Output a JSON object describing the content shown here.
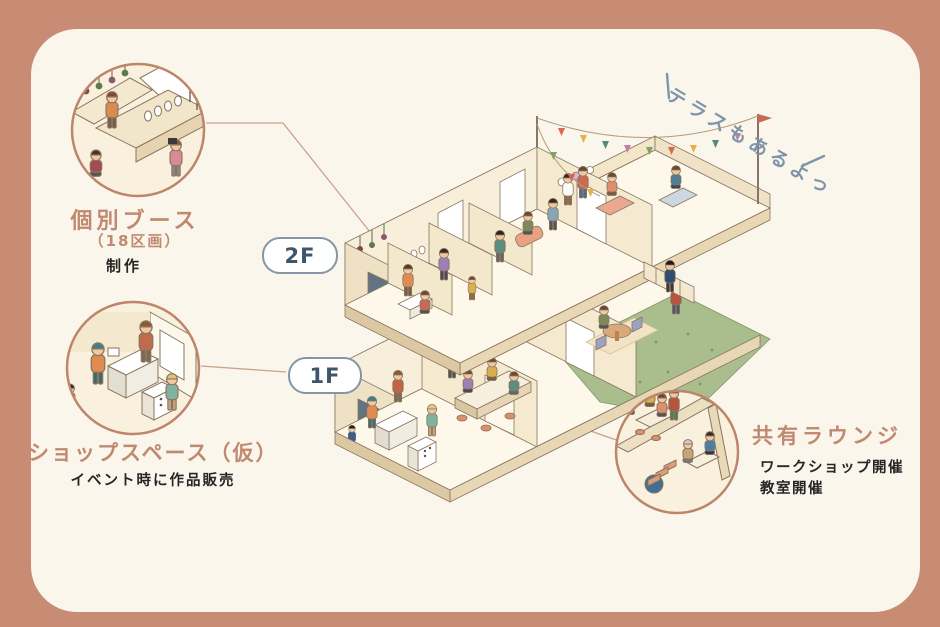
{
  "callouts": {
    "booth": {
      "title": "個別ブース",
      "subtitle": "（18区画）",
      "description": "制作"
    },
    "shop": {
      "title": "ショップスペース（仮）",
      "description": "イベント時に作品販売"
    },
    "lounge": {
      "title": "共有ラウンジ",
      "description_line1": "ワークショップ開催",
      "description_line2": "教室開催"
    }
  },
  "floor_labels": {
    "second_floor": "2F",
    "first_floor": "1F"
  },
  "terrace_note": "テラスもあるよっ",
  "colors": {
    "frame_border": "#c78c73",
    "panel_background": "#fbf6ec",
    "accent_text": "#bf8a70",
    "dark_text": "#262626",
    "floor_pill_text": "#3d566b",
    "floor_pill_border": "#8496a4",
    "terrace_note_text": "#7e95a9",
    "connector_line": "#c9a28d",
    "building_wall": "#f8efdb",
    "garden_green": "#a9bd8d"
  }
}
